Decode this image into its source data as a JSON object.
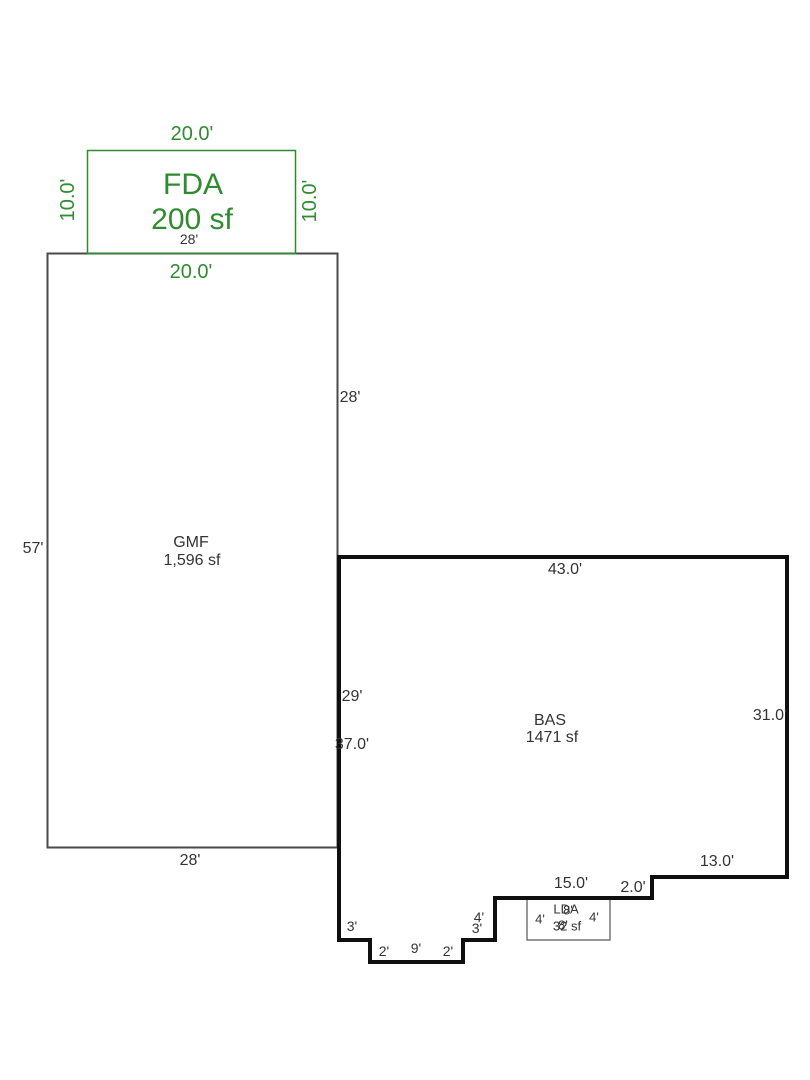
{
  "sketch": {
    "colors": {
      "fda_accent": "#2e8b2e",
      "gmf_line": "#4a4a4a",
      "bas_line": "#0f0f0f",
      "lda_line": "#777777",
      "dim_text": "#333333"
    },
    "fda": {
      "code": "FDA",
      "area": "200 sf",
      "dim_top": "20.0'",
      "dim_bottom": "20.0'",
      "dim_left": "10.0'",
      "dim_right": "10.0'"
    },
    "gmf": {
      "code": "GMF",
      "area": "1,596 sf",
      "dim_top": "28'",
      "dim_bottom": "28'",
      "dim_left": "57'",
      "dim_right_upper": "28'",
      "dim_right_lower": "29'"
    },
    "bas": {
      "code": "BAS",
      "area": "1471 sf",
      "dim_top": "43.0'",
      "dim_right": "31.0'",
      "dim_left": "37.0'",
      "dim_bottom_right": "13.0'",
      "dim_step_right": "2.0'",
      "dim_bottom_mid": "15.0'",
      "dim_step_mid_v": "4'",
      "dim_step_mid_h": "3'",
      "dim_notch_left_h": "3'",
      "dim_notch_left_v": "2'",
      "dim_notch_bottom": "9'",
      "dim_notch_right_v": "2'"
    },
    "lda": {
      "code": "LDA",
      "area": "32 sf",
      "dim_top": "8'",
      "dim_bottom": "8'",
      "dim_left": "4'",
      "dim_right": "4'"
    }
  }
}
